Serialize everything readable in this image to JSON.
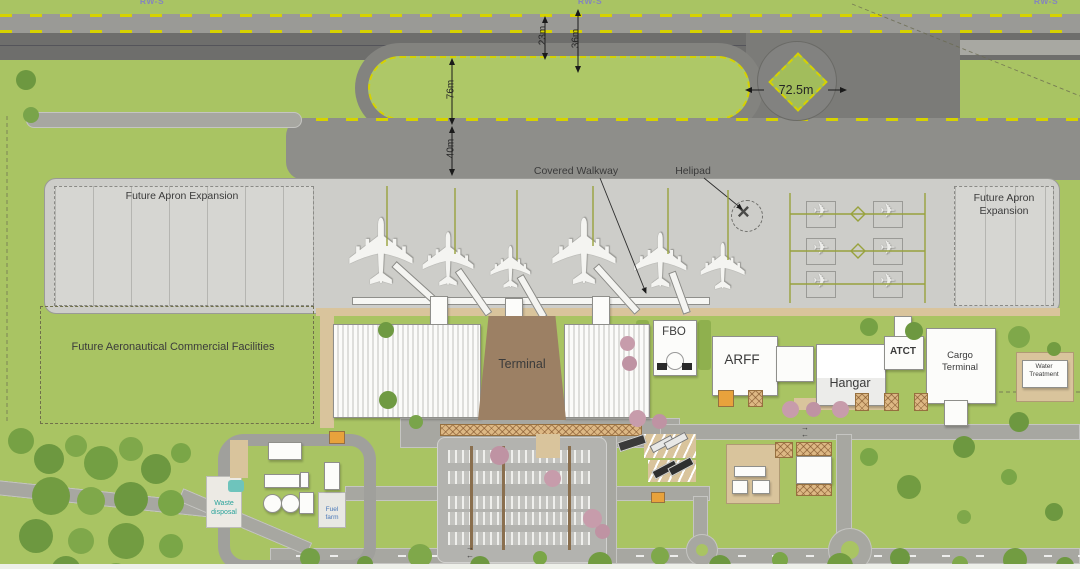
{
  "labels": {
    "runway_marker": "RW-S",
    "covered_walkway": "Covered Walkway",
    "helipad": "Helipad",
    "future_apron": "Future Apron Expansion",
    "future_commercial": "Future Aeronautical Commercial Facilities",
    "terminal": "Terminal",
    "fbo": "FBO",
    "arff": "ARFF",
    "hangar": "Hangar",
    "atct": "ATCT",
    "cargo_terminal": "Cargo Terminal",
    "water_treatment": "Water Treatment",
    "waste_disposal": "Waste disposal",
    "fuel_farm": "Fuel farm"
  },
  "dimensions": {
    "runway_width": "23m",
    "runway_shoulder": "36m",
    "infield_width": "76m",
    "taxiway_separation": "40m",
    "turnpad_width": "72.5m"
  },
  "icons": {
    "aircraft": "✈",
    "helicopter_rotor": "×",
    "arrow_right": "→",
    "arrow_left": "←"
  },
  "colors": {
    "grass": "#a9c463",
    "runway": "#6e6e6c",
    "taxiway": "#8e8e8a",
    "apron": "#cdcdc9",
    "marking_yellow": "#d6d200",
    "terminal_brown": "#9c8064"
  }
}
